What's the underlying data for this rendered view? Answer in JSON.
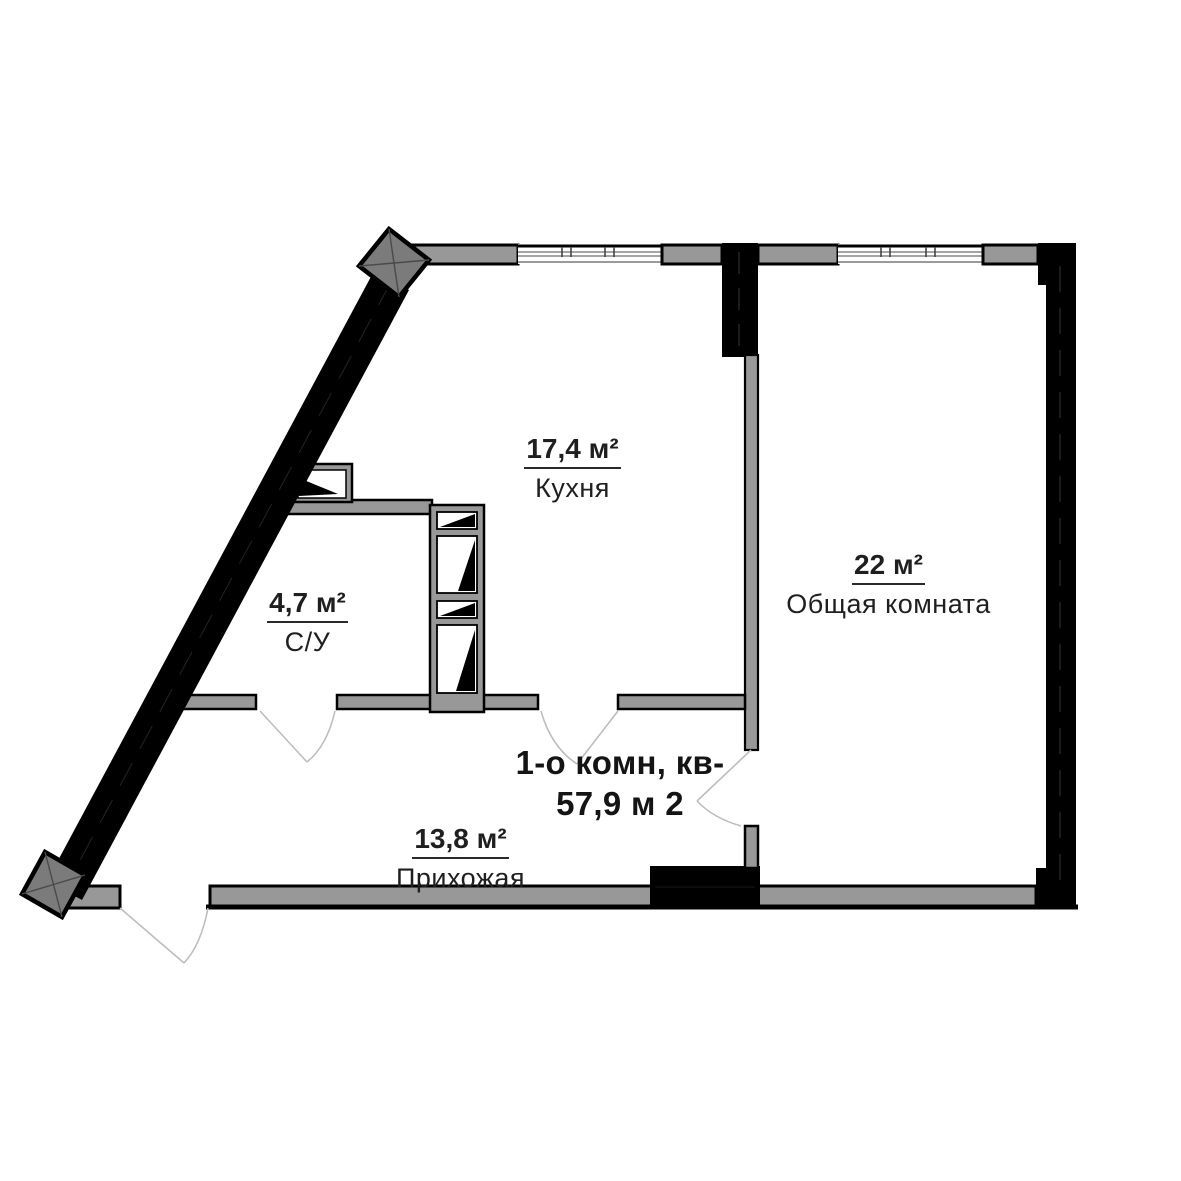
{
  "plan": {
    "title_line1": "1-о комн, кв-",
    "title_line2": "57,9 м 2",
    "rooms": [
      {
        "id": "kitchen",
        "area": "17,4 м²",
        "name": "Кухня"
      },
      {
        "id": "living-room",
        "area": "22 м²",
        "name": "Общая комната"
      },
      {
        "id": "bathroom",
        "area": "4,7 м²",
        "name": "С/У"
      },
      {
        "id": "hallway",
        "area": "13,8 м²",
        "name": "Прихожая"
      }
    ],
    "colors": {
      "wall_fill": "#989898",
      "wall_outline": "#000000",
      "column_fill": "#7b7b7b",
      "door_arc": "#bdbdbd",
      "text": "#1f1f1f"
    }
  }
}
